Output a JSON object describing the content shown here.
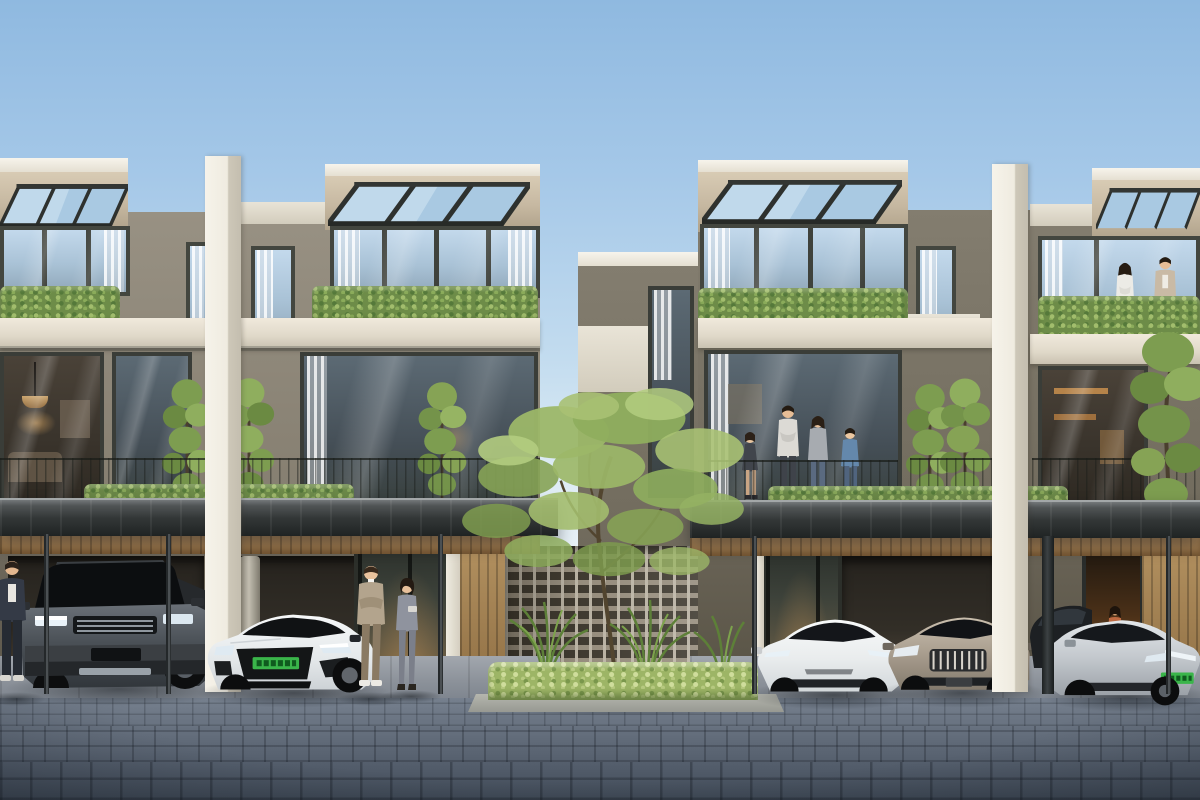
{
  "scene": {
    "kind": "photorealistic architectural exterior rendering",
    "label": "Modern three-storey townhouse row with carports, residents and parked electric cars",
    "time_of_day": "clear daylight",
    "sky": {
      "top": "#8fb9e0",
      "horizon": "#e9f1f6"
    }
  },
  "palette": {
    "facade_white": "#f2efe7",
    "facade_beige": "#c6b8a1",
    "facade_grey": "#8a8375",
    "frame_dark": "#3f423c",
    "glass_cool": "#b7d0e4",
    "hedge_green": "#6d8c48",
    "hedge_sunlit": "#9db566",
    "timber": "#a8845a",
    "canopy_steel": "#333737",
    "breeze_block": "#93897a",
    "paver_blue_grey": "#5d6673",
    "ev_plate_green": "#3ab54a"
  },
  "buildings": {
    "label": "row of flat-roofed modern townhouses",
    "storeys": 3,
    "units_visible": 4,
    "features": [
      "rooftop glass pergolas on steel rafters",
      "white party-wall fins between units",
      "hedge planters along balcony edges",
      "full-height glazing with sheer curtains",
      "steel carport canopies with slim posts",
      "perforated breeze-block screen wall at centre court",
      "timber soffits, slatted walls and entry doors"
    ],
    "left_block": {
      "label": "left townhouse pair",
      "wall": "#8a8375",
      "parapet": "#c6b8a1"
    },
    "center_link": {
      "label": "recessed link wall with tall slot window"
    },
    "right_block": {
      "label": "right townhouse pair",
      "wall": "#7b7568",
      "parapet": "#c6b8a1"
    }
  },
  "vehicles": [
    {
      "label": "dark grey luxury SUV parked in left carport",
      "body": "#45494e"
    },
    {
      "label": "white performance fastback with green EV plate",
      "body": "#eef0f1",
      "plate": "#3ab54a"
    },
    {
      "label": "white electric sedan in right carport",
      "body": "#f0f1f2"
    },
    {
      "label": "champagne-bronze sedan with chrome grille",
      "body": "#b3a89a"
    },
    {
      "label": "dark car partially hidden behind canopy post",
      "body": "#23262a"
    },
    {
      "label": "silver electric fastback with green EV plate",
      "body": "#c8ccd0",
      "plate": "#3ab54a"
    }
  ],
  "people": [
    {
      "label": "pedestrian partially visible at left edge"
    },
    {
      "label": "salesman in beige blazer with crossed arms"
    },
    {
      "label": "saleswoman in grey suit holding a tablet"
    },
    {
      "label": "family of four standing on second-floor balcony"
    },
    {
      "label": "couple standing on third-floor terrace behind hedge"
    },
    {
      "label": "woman standing in warmly lit doorway"
    }
  ],
  "vegetation": [
    {
      "label": "airy courtyard tree in centre planting island"
    },
    {
      "label": "columnar trees against the facades",
      "count": 5
    },
    {
      "label": "tall tree at right building corner"
    },
    {
      "label": "balcony hedge planters"
    },
    {
      "label": "planter hedges along carport canopies"
    },
    {
      "label": "sunlit hedge and tropical plants fronting breeze-block wall"
    }
  ],
  "ground": {
    "label": "blue-grey paver driveway with light concrete carport aprons and curbed planting island"
  }
}
